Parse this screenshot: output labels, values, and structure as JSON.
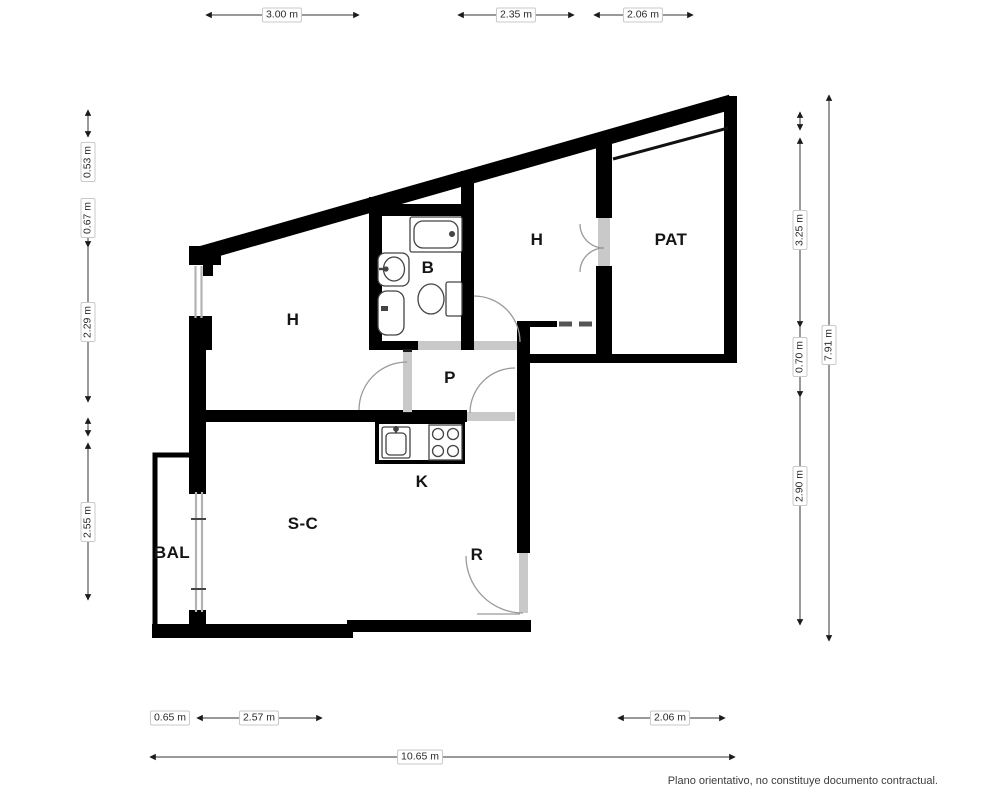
{
  "plan": {
    "type": "floorplan",
    "rooms": [
      {
        "id": "h1",
        "label": "H"
      },
      {
        "id": "b",
        "label": "B"
      },
      {
        "id": "h2",
        "label": "H"
      },
      {
        "id": "pat",
        "label": "PAT"
      },
      {
        "id": "p",
        "label": "P"
      },
      {
        "id": "k",
        "label": "K"
      },
      {
        "id": "sc",
        "label": "S-C"
      },
      {
        "id": "bal",
        "label": "BAL"
      },
      {
        "id": "r",
        "label": "R"
      }
    ],
    "dimensions": {
      "top": [
        {
          "label": "3.00 m"
        },
        {
          "label": "2.35 m"
        },
        {
          "label": "2.06 m"
        }
      ],
      "left": [
        {
          "label": "0.53 m"
        },
        {
          "label": "0.67 m"
        },
        {
          "label": "2.29 m"
        },
        {
          "label": "2.55 m"
        }
      ],
      "right": [
        {
          "label": "3.25 m"
        },
        {
          "label": "0.70 m"
        },
        {
          "label": "2.90 m"
        },
        {
          "label": "7.91 m"
        }
      ],
      "bottom": [
        {
          "label": "0.65 m"
        },
        {
          "label": "2.57 m"
        },
        {
          "label": "2.06 m"
        },
        {
          "label": "10.65 m"
        }
      ]
    },
    "footer": "Plano orientativo, no constituye documento contractual.",
    "colors": {
      "wall": "#000000",
      "threshold": "#c9c9c9",
      "window": "#b3b3b3",
      "door_arc": "#9a9a9a",
      "dimension_line": "#333333",
      "background": "#ffffff"
    }
  }
}
